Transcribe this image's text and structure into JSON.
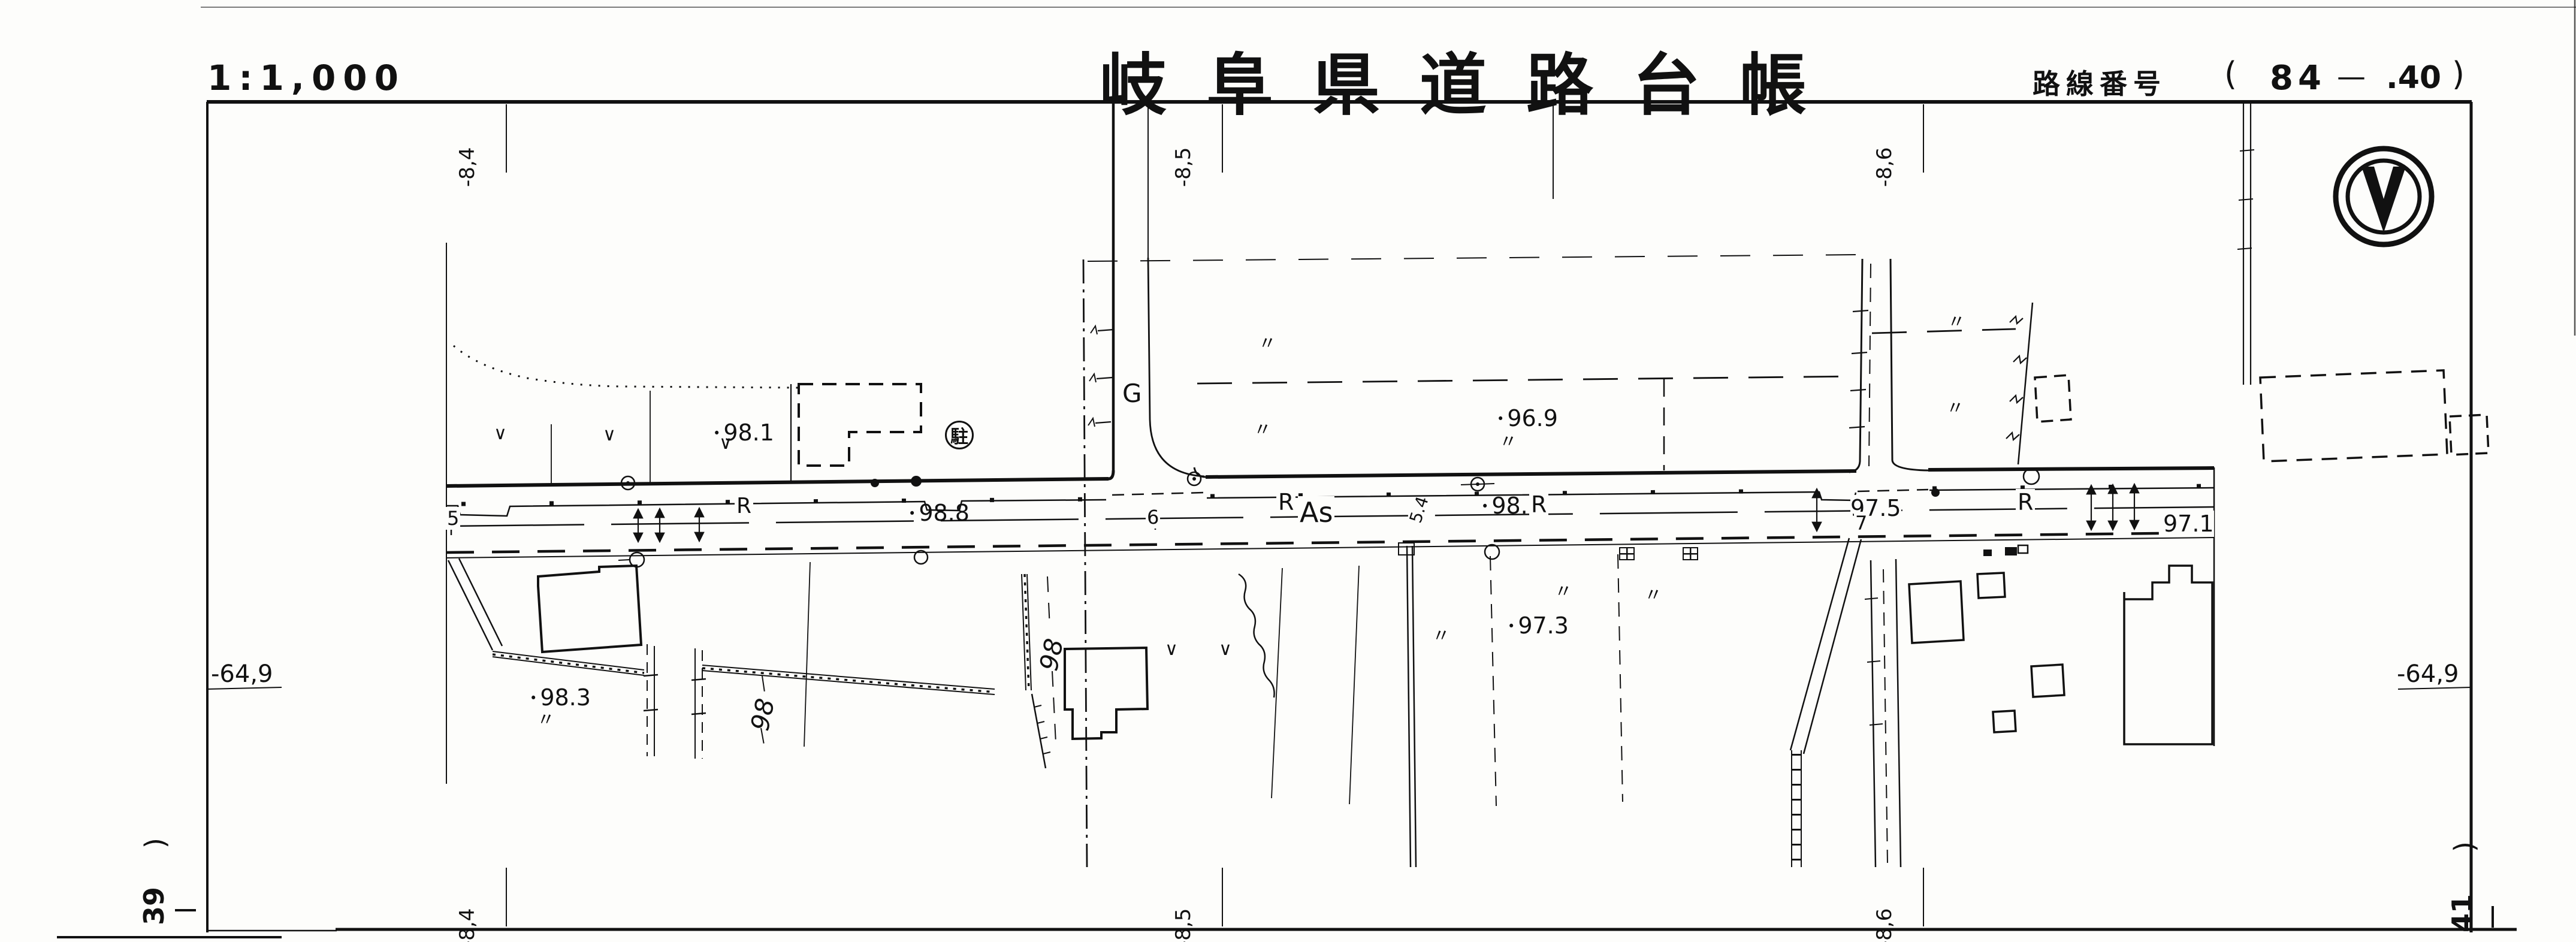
{
  "header": {
    "scale": "1:1,000",
    "title": "岐阜県道路台帳",
    "route_label": "路線番号",
    "route_open": "(",
    "route_number": "84",
    "route_dash": "—",
    "route_sub": ".40",
    "route_close": ")"
  },
  "grid": {
    "top_labels": [
      "-8,4",
      "-8,5",
      "-8,6"
    ],
    "bottom_labels": [
      "-8,4",
      "-8,5",
      "-8,6"
    ],
    "left_label": "-64,9",
    "right_label": "-64,9",
    "corner_bottom_left": {
      "paren": ")",
      "number": "39"
    },
    "corner_bottom_right": {
      "paren": ")",
      "number": "41"
    }
  },
  "map": {
    "elevations": [
      {
        "value": "98.1"
      },
      {
        "value": "96.9"
      },
      {
        "value": "98.8"
      },
      {
        "value": "98.1"
      },
      {
        "value": "97.5"
      },
      {
        "value": "97.1"
      },
      {
        "value": "97.3"
      },
      {
        "value": "98.3"
      }
    ],
    "contours": [
      {
        "value": "98"
      },
      {
        "value": "98"
      }
    ],
    "surface_labels": [
      {
        "text": "G"
      },
      {
        "text": "R"
      },
      {
        "text": "R"
      },
      {
        "text": "As"
      },
      {
        "text": "R"
      },
      {
        "text": "R"
      }
    ],
    "stations": [
      {
        "text": "5"
      },
      {
        "text": "6"
      },
      {
        "text": "7"
      },
      {
        "text": "5.4"
      }
    ],
    "symbols": {
      "parking": "駐",
      "ditto": "〃",
      "check": "∨",
      "north_arrow": "north-arrow-icon",
      "paddy": "paddy-field-icon",
      "benchmark": "benchmark-circle-icon",
      "pole": "utility-pole-dot-icon"
    }
  }
}
